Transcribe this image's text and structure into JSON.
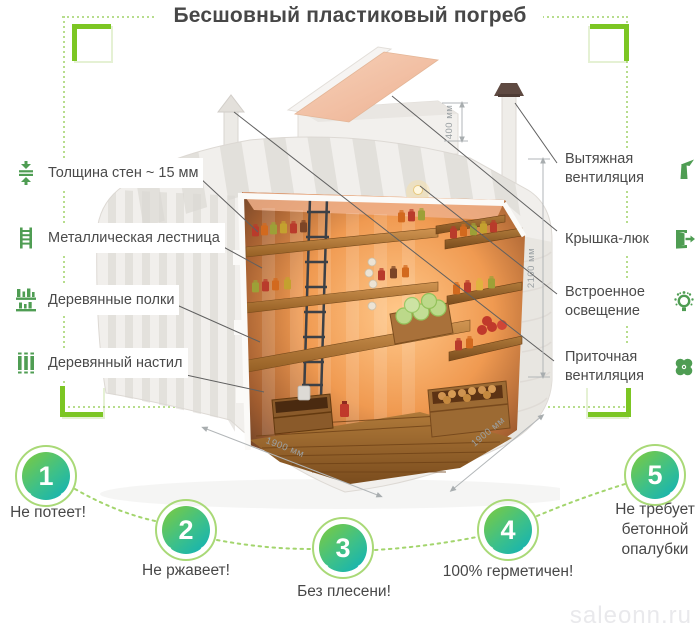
{
  "title": "Бесшовный пластиковый погреб",
  "watermark": "saleonn.ru",
  "features_left": [
    {
      "label": "Толщина стен ~ 15 мм",
      "icon": "wall-thickness"
    },
    {
      "label": "Металлическая лестница",
      "icon": "ladder"
    },
    {
      "label": "Деревянные полки",
      "icon": "shelves"
    },
    {
      "label": "Деревянный настил",
      "icon": "decking"
    }
  ],
  "features_right": [
    {
      "label": "Вытяжная вентиляция",
      "icon": "exhaust-vent"
    },
    {
      "label": "Крышка-люк",
      "icon": "hatch"
    },
    {
      "label": "Встроенное освещение",
      "icon": "light"
    },
    {
      "label": "Приточная вентиляция",
      "icon": "supply-vent"
    }
  ],
  "dimensions": {
    "neck_height": "400 мм",
    "inner_height": "2100 мм",
    "width": "1900 мм",
    "depth": "1900 мм"
  },
  "benefits": [
    {
      "number": "1",
      "label": "Не потеет!"
    },
    {
      "number": "2",
      "label": "Не ржавеет!"
    },
    {
      "number": "3",
      "label": "Без плесени!"
    },
    {
      "number": "4",
      "label": "100% герметичен!"
    },
    {
      "number": "5",
      "label": "Не требует бетонной опалубки"
    }
  ],
  "colors": {
    "accent_green": "#7cc623",
    "icon_green": "#4f9d53",
    "dotted_green": "#b7dd8d",
    "badge_gradient_start": "#79ca43",
    "badge_gradient_end": "#12b2b5",
    "text": "#4a4a4a",
    "dimension_gray": "#9ba1a4",
    "watermark_gray": "#e9e9ec"
  }
}
